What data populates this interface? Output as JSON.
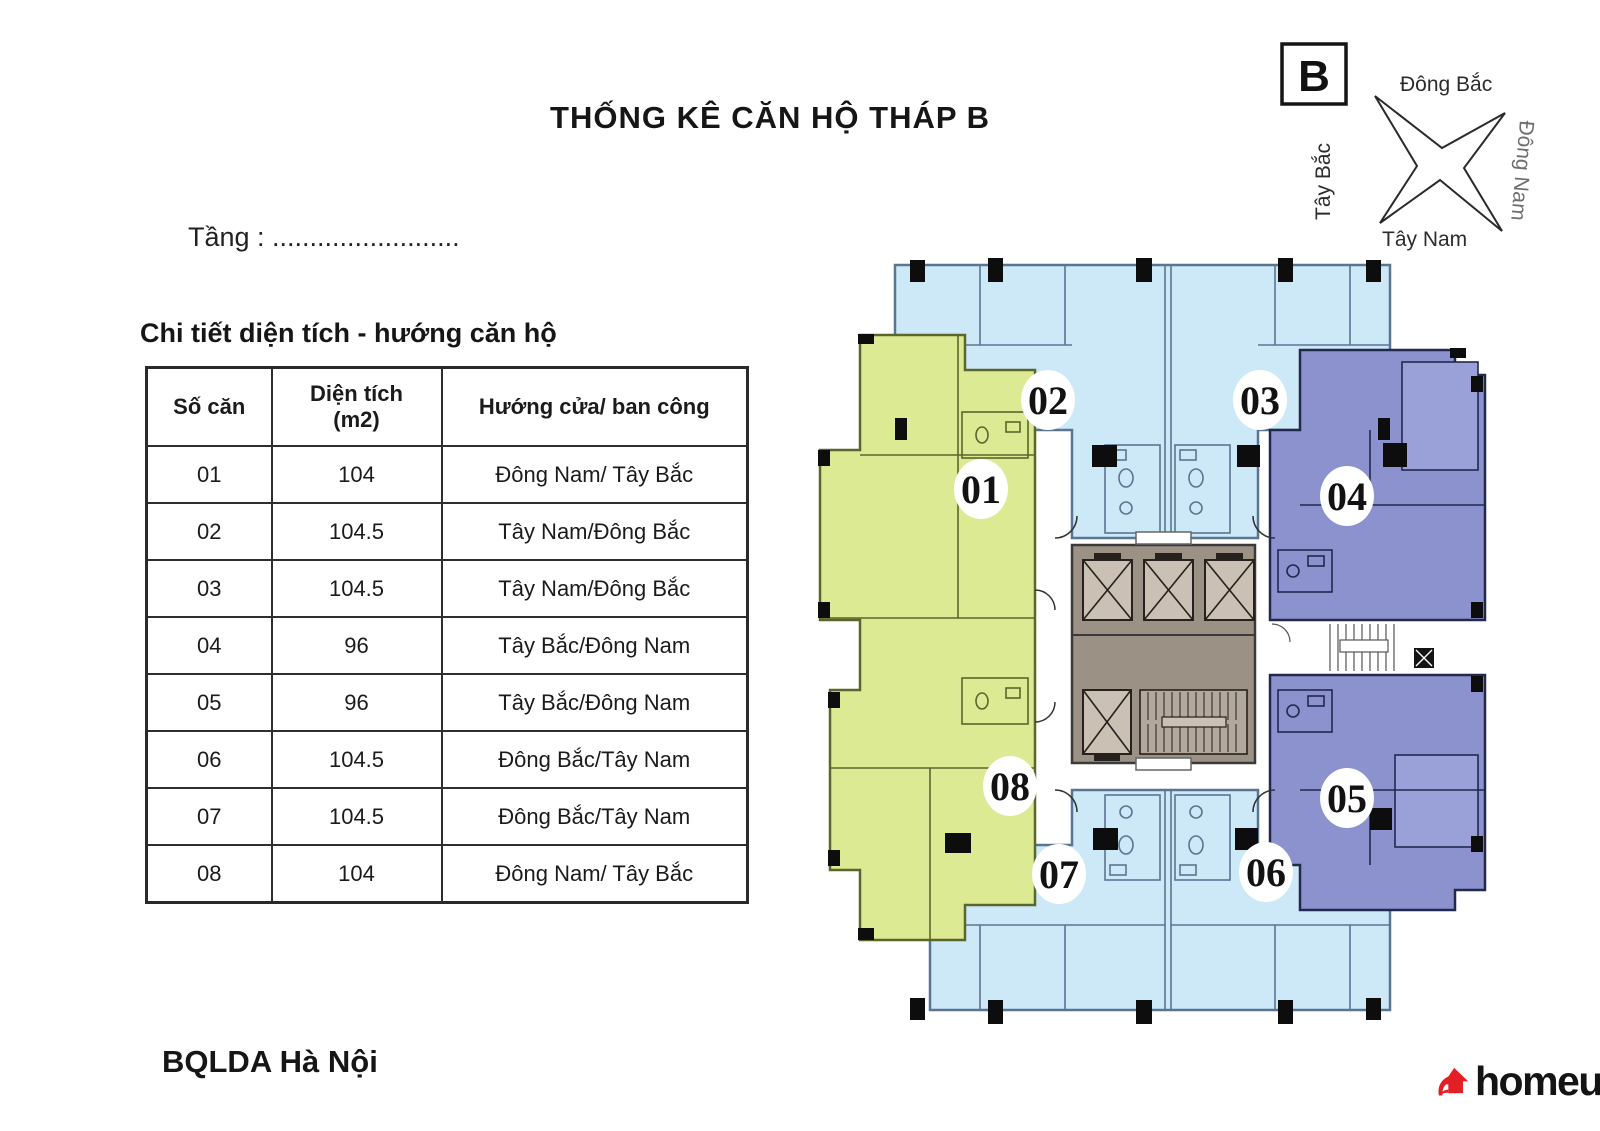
{
  "title": "THỐNG KÊ CĂN HỘ THÁP B",
  "floor_line": "Tầng : .........................",
  "table": {
    "caption": "Chi tiết diện tích - hướng căn hộ",
    "headers": {
      "unit": "Số căn",
      "area": "Diện tích",
      "area_unit": "(m2)",
      "direction": "Hướng cửa/ ban công"
    },
    "rows": [
      [
        "01",
        "104",
        "Đông Nam/ Tây Bắc"
      ],
      [
        "02",
        "104.5",
        "Tây Nam/Đông Bắc"
      ],
      [
        "03",
        "104.5",
        "Tây Nam/Đông Bắc"
      ],
      [
        "04",
        "96",
        "Tây Bắc/Đông Nam"
      ],
      [
        "05",
        "96",
        "Tây Bắc/Đông Nam"
      ],
      [
        "06",
        "104.5",
        "Đông Bắc/Tây Nam"
      ],
      [
        "07",
        "104.5",
        "Đông Bắc/Tây Nam"
      ],
      [
        "08",
        "104",
        "Đông Nam/ Tây Bắc"
      ]
    ]
  },
  "compass": {
    "tower": "B",
    "ne": "Đông Bắc",
    "se": "Đông Nam",
    "sw": "Tây Nam",
    "nw": "Tây Bắc"
  },
  "plan": {
    "units": [
      {
        "label": "01"
      },
      {
        "label": "02"
      },
      {
        "label": "03"
      },
      {
        "label": "04"
      },
      {
        "label": "05"
      },
      {
        "label": "06"
      },
      {
        "label": "07"
      },
      {
        "label": "08"
      }
    ]
  },
  "footer": {
    "issuer": "BQLDA Hà Nội",
    "brand": "homeup"
  },
  "colors": {
    "blue": "#cde9f7",
    "green": "#dcea94",
    "purple": "#8b92ce",
    "purpleLight": "#9aa1d8",
    "core": "#9b9184",
    "elevator": "#cac0b4",
    "stair": "#b2a89b",
    "wallBlue": "#5b7591",
    "wallGreen": "#5a662c",
    "wallPurple": "#23284e",
    "red": "#e31e24",
    "ink": "#1d1d1d"
  }
}
